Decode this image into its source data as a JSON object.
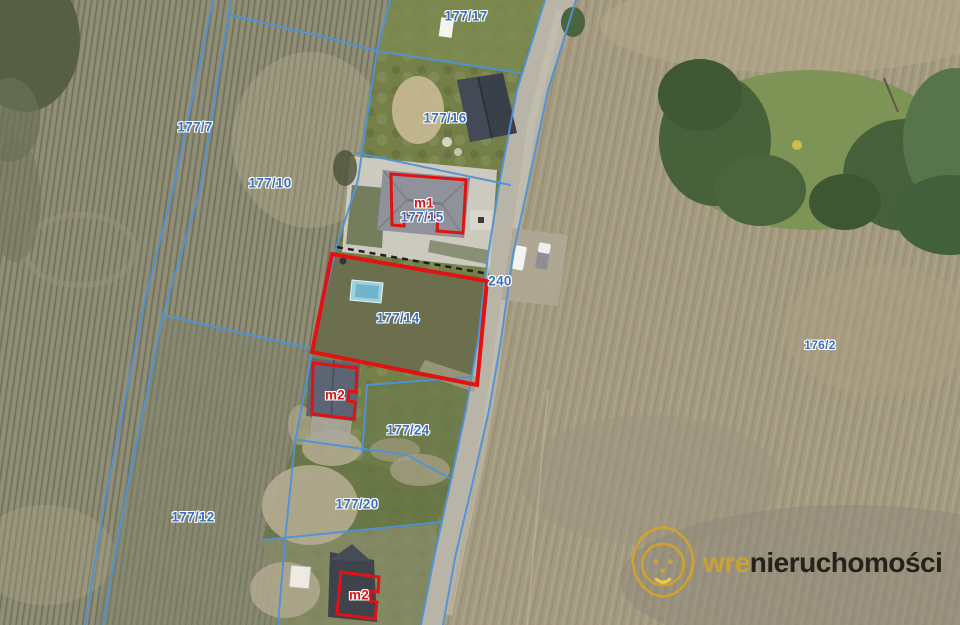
{
  "map": {
    "parcel_labels": [
      {
        "text": "177/7"
      },
      {
        "text": "177/10"
      },
      {
        "text": "177/12"
      },
      {
        "text": "177/14"
      },
      {
        "text": "177/15"
      },
      {
        "text": "177/16"
      },
      {
        "text": "177/17"
      },
      {
        "text": "177/20"
      },
      {
        "text": "177/24"
      },
      {
        "text": "176/2"
      }
    ],
    "road_label": {
      "text": "240"
    },
    "markers": [
      {
        "text": "m1"
      },
      {
        "text": "m2"
      },
      {
        "text": "m2"
      }
    ],
    "colors": {
      "boundary_blue": "#4e92d8",
      "highlight_red": "#e11212",
      "parcel_label_blue": "#3a6fc0",
      "marker_label_red": "#d81616",
      "logo_gold": "#d9a61f",
      "logo_text_dark": "#262219"
    }
  },
  "watermark": {
    "prefix": "wre",
    "name": "nieruchomości"
  }
}
